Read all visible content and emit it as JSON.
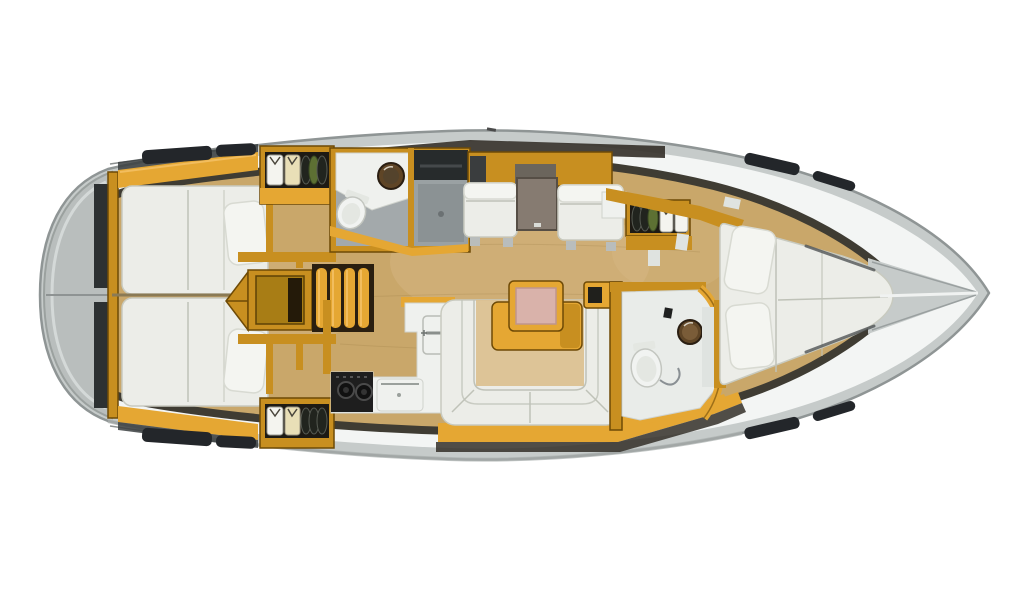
{
  "page": {
    "background": "#ffffff"
  },
  "diagram": {
    "kind": "sailing-yacht-interior-floor-plan",
    "view": "top-down",
    "orientation": "bow-right-stern-left",
    "regions": [
      {
        "id": "stern-platform"
      },
      {
        "id": "aft-cabin-port",
        "furniture": [
          "double-berth",
          "pillow"
        ]
      },
      {
        "id": "aft-cabin-starboard",
        "furniture": [
          "double-berth",
          "pillow"
        ]
      },
      {
        "id": "hanging-locker-port",
        "contents": [
          "shirt-white",
          "shirt-cream",
          "cd-stack"
        ]
      },
      {
        "id": "hanging-locker-starboard",
        "contents": [
          "shirt-white",
          "shirt-cream",
          "cd-stack"
        ]
      },
      {
        "id": "aft-head-with-shower",
        "fixtures": [
          "toilet",
          "washbasin",
          "shower-stall"
        ]
      },
      {
        "id": "companionway",
        "furniture": [
          "steps",
          "engine-box"
        ]
      },
      {
        "id": "galley",
        "fixtures": [
          "sink",
          "faucet",
          "stove-burners",
          "oven"
        ]
      },
      {
        "id": "saloon-port-side",
        "furniture": [
          "seat",
          "chart-table",
          "seat",
          "cabinets"
        ]
      },
      {
        "id": "saloon-starboard-side",
        "furniture": [
          "u-settee",
          "saloon-table",
          "folding-leaf"
        ]
      },
      {
        "id": "forward-head",
        "fixtures": [
          "toilet",
          "washbasin"
        ]
      },
      {
        "id": "wardrobe-forward",
        "contents": [
          "cd-stack",
          "shirt-white",
          "shirt-white"
        ]
      },
      {
        "id": "forward-cabin",
        "furniture": [
          "v-berth",
          "pillow",
          "pillow",
          "shelf"
        ]
      },
      {
        "id": "bow-deck"
      }
    ],
    "icons": [
      "toilet-icon",
      "washbasin-icon",
      "shower-icon",
      "faucet-icon",
      "stove-icon",
      "oven-icon",
      "sink-icon",
      "clothes-shirt-icon",
      "cd-stack-icon",
      "deck-hatch-icon",
      "pillow-icon",
      "mast-step-icon",
      "steps-icon"
    ]
  },
  "colors": {
    "hull-outer": "#c6cbca",
    "hull-stroke": "#8f9595",
    "hull-shade": "#a9afae",
    "deck": "#f3f5f4",
    "stern-cap": "#b9bebd",
    "interior-edge": "#3f3c33",
    "floor": "#c9a76a",
    "floor-light": "#dcbf8e",
    "wood": "#e5a733",
    "wood-mid": "#c88f20",
    "wood-dark": "#9a6c10",
    "wood-deep": "#6e4a06",
    "wood-hi": "#f3c063",
    "cushion": "#ecede8",
    "cushion-line": "#bfc2b8",
    "pillow": "#f4f5f1",
    "dark-panel": "#2d3132",
    "dark-band": "#332f28",
    "table-top": "#867b71",
    "table-edge": "#564e45",
    "pink": "#d9b2aa",
    "pink-edge": "#bf958c",
    "shower": "#9aa1a3",
    "shower-dark": "#272b2c",
    "toilet": "#f1f3f1",
    "sink-brown": "#5f4526",
    "sink-rim": "#2a1e12",
    "stove": "#1e1e1e",
    "white-goods": "#eff1ee",
    "shirt-white": "#f4f4ef",
    "shirt-cream": "#e9dfb7",
    "disc-dark": "#21241e",
    "disc-green": "#5d7033",
    "hatch": "#23262a"
  }
}
